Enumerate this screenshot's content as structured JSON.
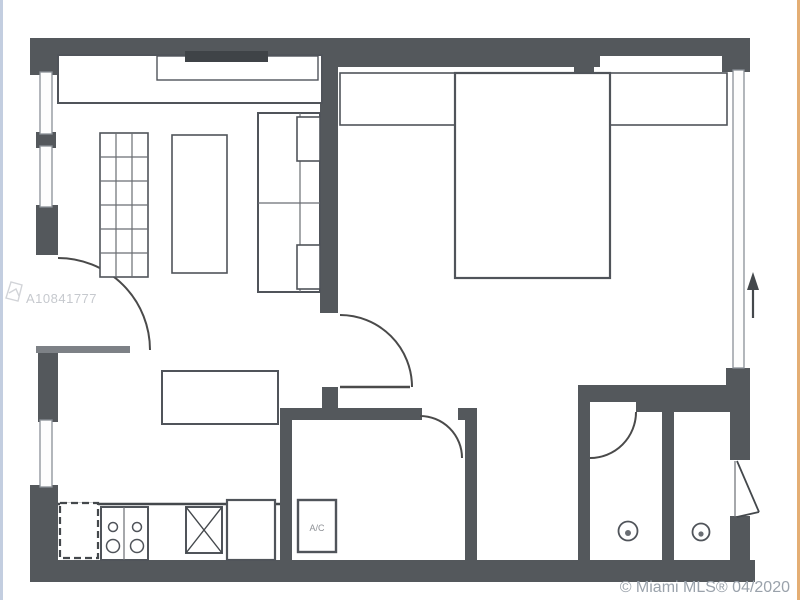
{
  "plan": {
    "ac_label": "A/C"
  },
  "watermark": {
    "id_text": "A10841777",
    "logo_icon": "mls-logo-icon"
  },
  "footer": {
    "credit": "© Miami MLS® 04/2020"
  },
  "icons": {
    "north_arrow": "up-arrow-icon"
  },
  "colors": {
    "background": "#ffffff",
    "wall": "#54585c",
    "plan_line": "#4a4a4a",
    "window_frame": "#8a9097",
    "watermark_text": "#c6c9ce",
    "credit_text": "#9aa2ab",
    "left_edge_artifact": "#b9c6da",
    "right_edge_artifact": "#dfa05c"
  }
}
